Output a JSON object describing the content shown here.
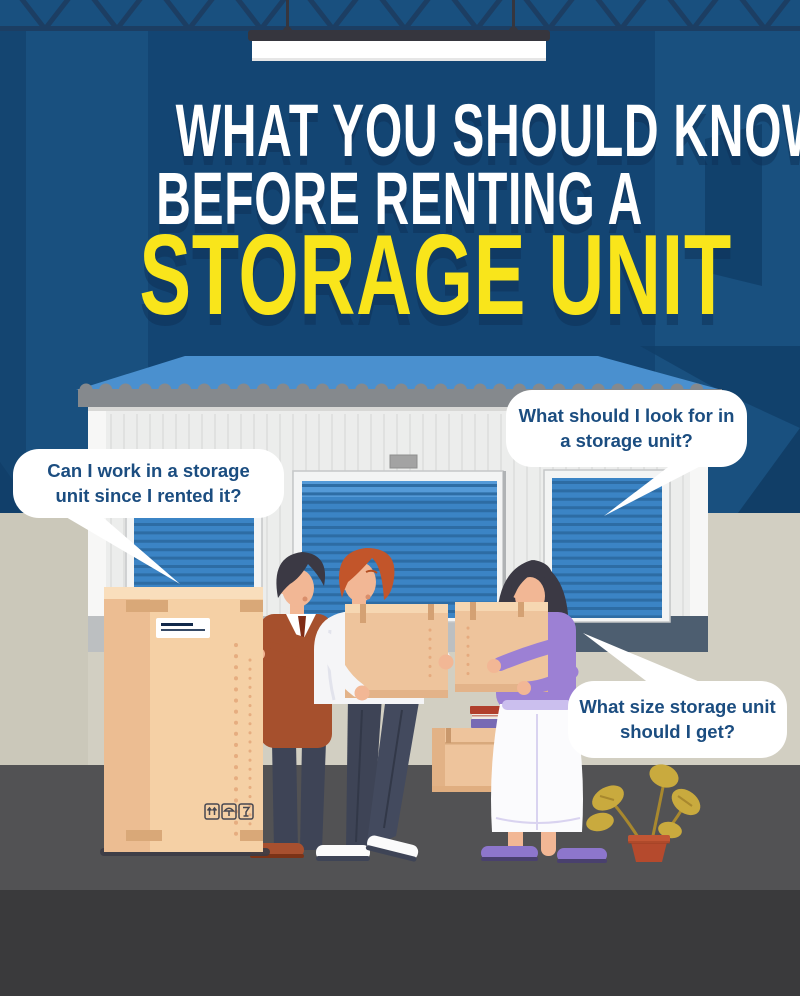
{
  "title": {
    "line1": "WHAT YOU SHOULD KNOW",
    "line2": "BEFORE RENTING A",
    "line3": "STORAGE UNIT"
  },
  "bubbles": {
    "left": {
      "line1": "Can I work in a storage",
      "line2": "unit since I rented it?"
    },
    "top_right": {
      "line1": "What should I look for in",
      "line2": "a storage unit?"
    },
    "bottom_right": {
      "line1": "What size storage unit",
      "line2": "should I get?"
    }
  },
  "box_icons": [
    "this-way-up",
    "keep-dry",
    "fragile"
  ],
  "colors": {
    "wall_blue_side": "#19507f",
    "wall_blue_center": "#134573",
    "truss_navy": "#1c3e63",
    "title_white": "#ffffff",
    "title_yellow": "#f9e51b",
    "awning_blue": "#4a90cf",
    "scallop_gray": "#85898d",
    "building_gray": "#ecedec",
    "door_blue": "#3b84c5",
    "door_slat_blue": "#2d6ba3",
    "ground_beige": "#d2cfc2",
    "floor_gray": "#525254",
    "floor_dark": "#3a3a3c",
    "box_tan": "#f5d0a5",
    "carton_tan": "#eec49c",
    "sweater_rust": "#a6502d",
    "hair_orange": "#c2552a",
    "top_purple": "#9c80d4",
    "pot_terracotta": "#b54a2d",
    "leaf_olive": "#c9aa3e",
    "bubble_text_navy": "#1b4d80"
  }
}
